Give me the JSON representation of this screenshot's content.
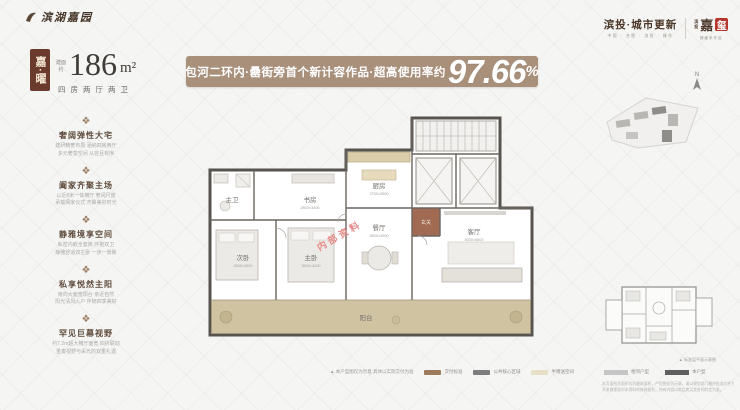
{
  "logo": {
    "name": "滨湖嘉园"
  },
  "unit": {
    "badge_text": "嘉·曜",
    "badge_bg": "#6a3a2d",
    "area_prefix_top": "建面",
    "area_prefix_bottom": "约",
    "area_value": "186",
    "area_unit": "m²",
    "layout_text": "四房两厅两卫"
  },
  "banner": {
    "lead": "包河二环内·罍街旁首个新计容作品·超高使用率约",
    "value": "97.66",
    "percent": "%",
    "bg": "#a8907b"
  },
  "icons": {
    "ornament": "❖",
    "compass_n": "N",
    "caption_mark": "▲"
  },
  "features": [
    {
      "title": "奢阔弹性大宅",
      "line1": "建研精奢布局 涵纳四房两厅",
      "line2": "多元奢享空间 从容且有序"
    },
    {
      "title": "阖家齐聚主场",
      "line1": "以近8米一体横厅 奢阔尺度",
      "line2": "承载阖家仪式 齐聚美好时光"
    },
    {
      "title": "静雅境享空间",
      "line1": "私密内嵌全套房 环抱双卫",
      "line2": "静雅舒适双主卧 一步一景致"
    },
    {
      "title": "私享悦然主阳",
      "line1": "南向大面宽阳台 亲近自然",
      "line2": "阳光清风入户 伴随四季美好"
    },
    {
      "title": "罕见巨幕视野",
      "line1": "约7.2m超大横厅面宽 四折联动",
      "line2": "重奏视野与采光的双重礼遇"
    }
  ],
  "floorplan": {
    "watermark": "内部资料",
    "watermark_color": "#e58b88",
    "rooms": [
      {
        "label": "厨房",
        "dim": "2700×3600"
      },
      {
        "label": "餐厅",
        "dim": "2800×3900"
      },
      {
        "label": "客厅",
        "dim": "4500×6800"
      },
      {
        "label": "主卫",
        "dim": ""
      },
      {
        "label": "书房",
        "dim": "2800×3300"
      },
      {
        "label": "次卧",
        "dim": "3300×3600"
      },
      {
        "label": "主卧",
        "dim": "3600×4200"
      },
      {
        "label": "玄关",
        "dim": ""
      },
      {
        "label": "阳台",
        "dim": ""
      }
    ]
  },
  "legend_main": {
    "note": "▲ 本户型图仅为示意 具体以实际交付为准",
    "items": [
      {
        "label": "交付标准",
        "color": "#9d7c5e"
      },
      {
        "label": "公共核心区域",
        "color": "#7d7d7d"
      },
      {
        "label": "半赠送空间",
        "color": "#e8e0c6"
      }
    ]
  },
  "brand": {
    "primary": "滨投·城市更新",
    "primary_sub": "中国 · 合肥 · 滨投 · 臻作",
    "seal_left_top": "滨",
    "seal_left_bottom": "投",
    "seal_char_1": "嘉",
    "seal_char_2": "玺",
    "seal_sub": "臻藏系作品",
    "seal_red": "#b5362c"
  },
  "keyplan": {
    "caption": "▲ 标准层平面示意图",
    "legend": [
      {
        "label": "相邻户型",
        "color": "#c6c6c6"
      },
      {
        "label": "本户型",
        "color": "#5f5f5f"
      }
    ],
    "fineprint_1": "本页面所涉面积均为建筑面积，户型图仅为示意，请以规划部门最终批准文件为准；",
    "fineprint_2": "开发商保留对本资料的修改权利，所有内容以商品房买卖合同约定为准。"
  }
}
